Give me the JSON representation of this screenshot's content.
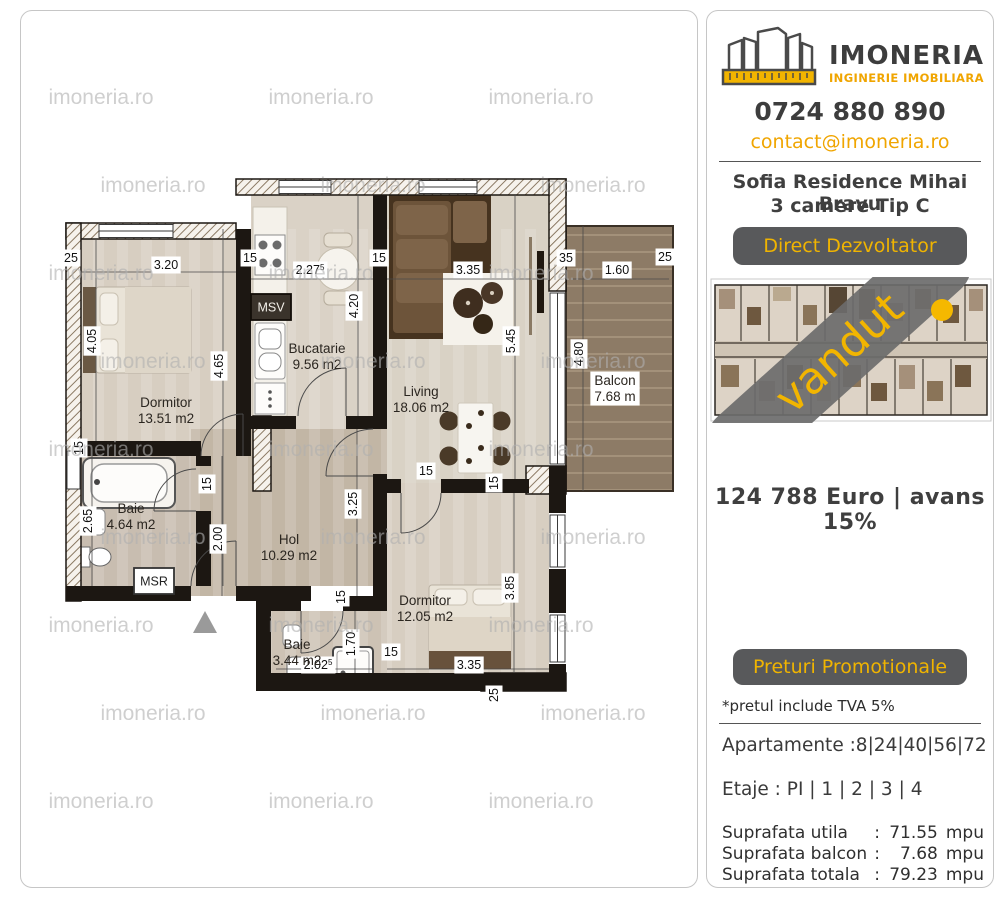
{
  "brand": {
    "name": "IMONERIA",
    "tagline": "INGINERIE IMOBILIARA",
    "phone": "0724 880 890",
    "email": "contact@imoneria.ro"
  },
  "watermark": {
    "text": "imoneria.ro"
  },
  "listing": {
    "title_line1": "Sofia Residence Mihai Bravu",
    "title_line2": "3 camere Tip C",
    "direct_badge": "Direct Dezvoltator",
    "sold_label": "vandut",
    "price_line": "124 788 Euro | avans 15%",
    "promo_badge": "Preturi Promotionale",
    "vat_note": "*pretul include TVA 5%",
    "apartments_line": "Apartamente :8|24|40|56|72",
    "floors_line": "Etaje : PI | 1 | 2 | 3 | 4"
  },
  "areas": {
    "rows": [
      {
        "label": "Suprafata utila",
        "sep": ":",
        "value": "71.55",
        "unit": "mpu"
      },
      {
        "label": "Suprafata balcon",
        "sep": ":",
        "value": "7.68",
        "unit": "mpu"
      },
      {
        "label": "Suprafata totala",
        "sep": ":",
        "value": "79.23",
        "unit": "mpu"
      }
    ]
  },
  "floor_plan": {
    "rooms": [
      {
        "name": "Dormitor",
        "area": "13.51 m2",
        "x": 145,
        "y": 396
      },
      {
        "name": "Bucatarie",
        "area": "9.56 m2",
        "x": 296,
        "y": 342
      },
      {
        "name": "Living",
        "area": "18.06 m2",
        "x": 400,
        "y": 385
      },
      {
        "name": "Balcon",
        "area": "7.68 m",
        "x": 594,
        "y": 374,
        "chip": true
      },
      {
        "name": "Baie",
        "area": "4.64 m2",
        "x": 110,
        "y": 502
      },
      {
        "name": "Hol",
        "area": "10.29 m2",
        "x": 268,
        "y": 533
      },
      {
        "name": "Baie",
        "area": "3.44 m2",
        "x": 276,
        "y": 638
      },
      {
        "name": "Dormitor",
        "area": "12.05 m2",
        "x": 404,
        "y": 594
      }
    ],
    "dims": [
      {
        "t": "25",
        "x": 50,
        "y": 251
      },
      {
        "t": "3.20",
        "x": 145,
        "y": 258
      },
      {
        "t": "15",
        "x": 229,
        "y": 251
      },
      {
        "t": "2.27",
        "sup": "5",
        "x": 289,
        "y": 263
      },
      {
        "t": "15",
        "x": 358,
        "y": 251
      },
      {
        "t": "3.35",
        "x": 447,
        "y": 263
      },
      {
        "t": "35",
        "x": 545,
        "y": 251
      },
      {
        "t": "1.60",
        "x": 596,
        "y": 263
      },
      {
        "t": "25",
        "x": 644,
        "y": 250
      },
      {
        "t": "4.05",
        "x": 75,
        "y": 330,
        "v": 1
      },
      {
        "t": "4.65",
        "x": 202,
        "y": 355,
        "v": 1
      },
      {
        "t": "4.20",
        "x": 337,
        "y": 295,
        "v": 1
      },
      {
        "t": "5.45",
        "x": 494,
        "y": 330,
        "v": 1
      },
      {
        "t": "4.80",
        "x": 562,
        "y": 343,
        "v": 1
      },
      {
        "t": "15",
        "x": 62,
        "y": 437,
        "v": 1
      },
      {
        "t": "2.65",
        "x": 71,
        "y": 510,
        "v": 1
      },
      {
        "t": "15",
        "x": 190,
        "y": 473,
        "v": 1
      },
      {
        "t": "2.00",
        "x": 201,
        "y": 528,
        "v": 1
      },
      {
        "t": "3.25",
        "x": 336,
        "y": 493,
        "v": 1
      },
      {
        "t": "15",
        "x": 405,
        "y": 464
      },
      {
        "t": "15",
        "x": 477,
        "y": 472,
        "v": 1
      },
      {
        "t": "15",
        "x": 324,
        "y": 586,
        "v": 1
      },
      {
        "t": "1.70",
        "x": 334,
        "y": 633,
        "v": 1
      },
      {
        "t": "15",
        "x": 370,
        "y": 645
      },
      {
        "t": "2.02",
        "sup": "5",
        "x": 297,
        "y": 658
      },
      {
        "t": "3.35",
        "x": 448,
        "y": 658
      },
      {
        "t": "3.85",
        "x": 493,
        "y": 577,
        "v": 1
      },
      {
        "t": "25",
        "x": 477,
        "y": 684,
        "v": 1
      }
    ],
    "wall_boxes": [
      {
        "text": "MSV",
        "x": 250,
        "y": 296,
        "style": "dark"
      },
      {
        "text": "MSR",
        "x": 133,
        "y": 570,
        "style": "light"
      }
    ]
  },
  "colors": {
    "accent": "#F0A500",
    "dark_text": "#3F3F3F",
    "badge_bg": "#58595B",
    "sold_banner": "#6B6B6B",
    "marker_dot": "#F5B800"
  }
}
